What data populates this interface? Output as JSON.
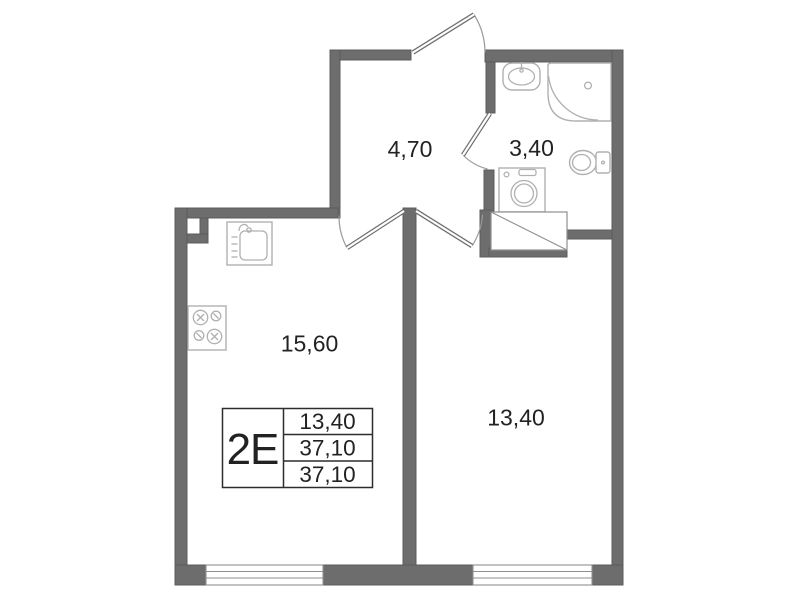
{
  "floor_plan": {
    "unit_code": "2Е",
    "stats_table": {
      "row1": "13,40",
      "row2": "37,10",
      "row3": "37,10"
    },
    "rooms": {
      "hallway": {
        "area": "4,70"
      },
      "bathroom": {
        "area": "3,40"
      },
      "kitchen_living": {
        "area": "15,60"
      },
      "bedroom": {
        "area": "13,40"
      }
    },
    "icons": [
      "entrance-door-icon",
      "bathroom-door-icon",
      "kitchen-door-icon",
      "bedroom-door-icon",
      "bathroom-sink-icon",
      "shower-icon",
      "toilet-icon",
      "washing-machine-icon",
      "vent-shaft-icon",
      "kitchen-sink-icon",
      "stove-icon",
      "window-kitchen",
      "window-bedroom"
    ],
    "colors": {
      "wall": "#6d6d6d",
      "fixture_line": "#b0b0b0",
      "door_line": "#6f6f6f",
      "text": "#222222",
      "table_border": "#2d2d2d",
      "background": "#ffffff"
    }
  }
}
